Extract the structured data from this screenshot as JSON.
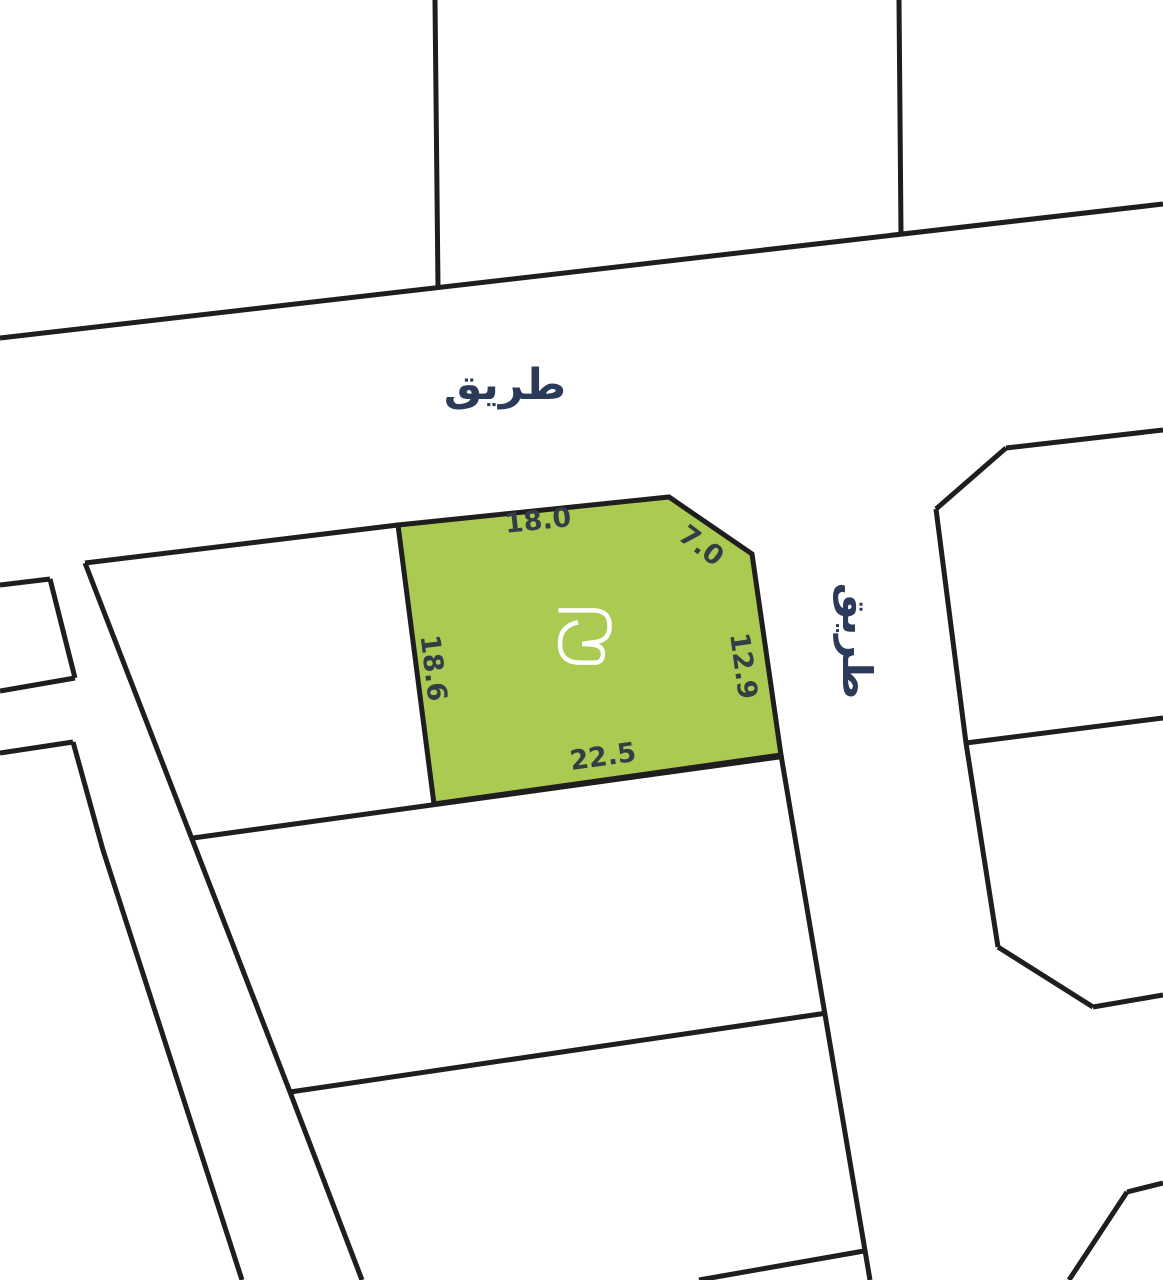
{
  "canvas": {
    "width": 1163,
    "height": 1280,
    "background": "#ffffff"
  },
  "style": {
    "boundary_color": "#1f1d1e",
    "boundary_width": 5,
    "plot_fill": "#abca52",
    "plot_stroke": "#1f1d1e",
    "road_label_color": "#2b3a59",
    "dimension_color": "#333d46",
    "dimension_font_size": 27,
    "logo_color": "#ffffff"
  },
  "road_labels": [
    {
      "id": "horizontal-road",
      "text": "طريق",
      "x": 505,
      "y": 385,
      "rotation": 0,
      "font_size": 43
    },
    {
      "id": "vertical-road",
      "text": "طريق",
      "x": 857,
      "y": 641,
      "rotation": 90,
      "font_size": 41
    }
  ],
  "highlight_plot": {
    "vertices": [
      [
        398,
        525
      ],
      [
        669,
        497
      ],
      [
        752,
        554
      ],
      [
        781,
        755
      ],
      [
        434,
        804
      ]
    ],
    "dimensions": [
      {
        "value": "18.0",
        "x": 538,
        "y": 521,
        "rotation": -6
      },
      {
        "value": "7.0",
        "x": 701,
        "y": 546,
        "rotation": 37
      },
      {
        "value": "12.9",
        "x": 743,
        "y": 666,
        "rotation": 82
      },
      {
        "value": "22.5",
        "x": 603,
        "y": 757,
        "rotation": -8
      },
      {
        "value": "18.6",
        "x": 433,
        "y": 668,
        "rotation": 83
      }
    ]
  },
  "boundaries": [
    {
      "name": "top-left-plot-boundary",
      "points": [
        [
          435,
          0
        ],
        [
          438,
          288
        ]
      ]
    },
    {
      "name": "top-right-plot-boundary",
      "points": [
        [
          899,
          0
        ],
        [
          901,
          234
        ]
      ]
    },
    {
      "name": "road-top-edge",
      "points": [
        [
          0,
          338
        ],
        [
          1163,
          204
        ]
      ]
    },
    {
      "name": "left-plot-top-edge",
      "points": [
        [
          0,
          585
        ],
        [
          50,
          579
        ]
      ]
    },
    {
      "name": "left-plot-right-edge",
      "points": [
        [
          50,
          579
        ],
        [
          75,
          678
        ]
      ]
    },
    {
      "name": "left-plot-bottom-edge",
      "points": [
        [
          75,
          678
        ],
        [
          0,
          691
        ]
      ]
    },
    {
      "name": "lower-left-plot-top-edge",
      "points": [
        [
          0,
          753
        ],
        [
          73,
          742
        ]
      ]
    },
    {
      "name": "lower-left-plot-right-edge",
      "points": [
        [
          73,
          742
        ],
        [
          103,
          850
        ],
        [
          242,
          1280
        ]
      ]
    },
    {
      "name": "diagonal-street-east-edge",
      "points": [
        [
          85,
          563
        ],
        [
          290,
          1092
        ],
        [
          362,
          1280
        ]
      ]
    },
    {
      "name": "row1-top-edge",
      "points": [
        [
          85,
          563
        ],
        [
          398,
          525
        ]
      ]
    },
    {
      "name": "row2-top-edge",
      "points": [
        [
          193,
          838
        ],
        [
          779,
          757
        ]
      ]
    },
    {
      "name": "row2-bottom-edge",
      "points": [
        [
          290,
          1092
        ],
        [
          827,
          1013
        ]
      ]
    },
    {
      "name": "row3-bottom-edge",
      "points": [
        [
          699,
          1280
        ],
        [
          864,
          1251
        ]
      ]
    },
    {
      "name": "vertical-road-west-edge",
      "points": [
        [
          781,
          755
        ],
        [
          870,
          1280
        ]
      ]
    },
    {
      "name": "octagon-plot-top-edge",
      "points": [
        [
          1006,
          448
        ],
        [
          1163,
          430
        ]
      ]
    },
    {
      "name": "octagon-plot-chamfer",
      "points": [
        [
          1006,
          448
        ],
        [
          936,
          509
        ]
      ]
    },
    {
      "name": "octagon-plot-left-edge",
      "points": [
        [
          936,
          509
        ],
        [
          966,
          743
        ],
        [
          998,
          947
        ]
      ]
    },
    {
      "name": "octagon-plot-divider",
      "points": [
        [
          966,
          743
        ],
        [
          1163,
          718
        ]
      ]
    },
    {
      "name": "octagon-plot-bottom-diagonal",
      "points": [
        [
          998,
          947
        ],
        [
          1093,
          1007
        ]
      ]
    },
    {
      "name": "octagon-plot-bottom-edge",
      "points": [
        [
          1093,
          1007
        ],
        [
          1163,
          995
        ]
      ]
    },
    {
      "name": "corner-plot-top-edge",
      "points": [
        [
          1127,
          1192
        ],
        [
          1163,
          1183
        ]
      ]
    },
    {
      "name": "corner-plot-left-edge",
      "points": [
        [
          1127,
          1192
        ],
        [
          1069,
          1280
        ]
      ]
    }
  ],
  "logo": {
    "x": 557,
    "y": 607,
    "scale": 0.335,
    "stroke_width": 13.5,
    "paths": [
      "M 4 10 L 108 10 Q 157 10 157 57 Q 157 101 111 105 L 76 110",
      "M 63 46 Q 9 56 9 110 Q 9 166 70 166 L 113 166 Q 137 166 137 139 Q 137 114 101 112 L 75 110"
    ]
  }
}
